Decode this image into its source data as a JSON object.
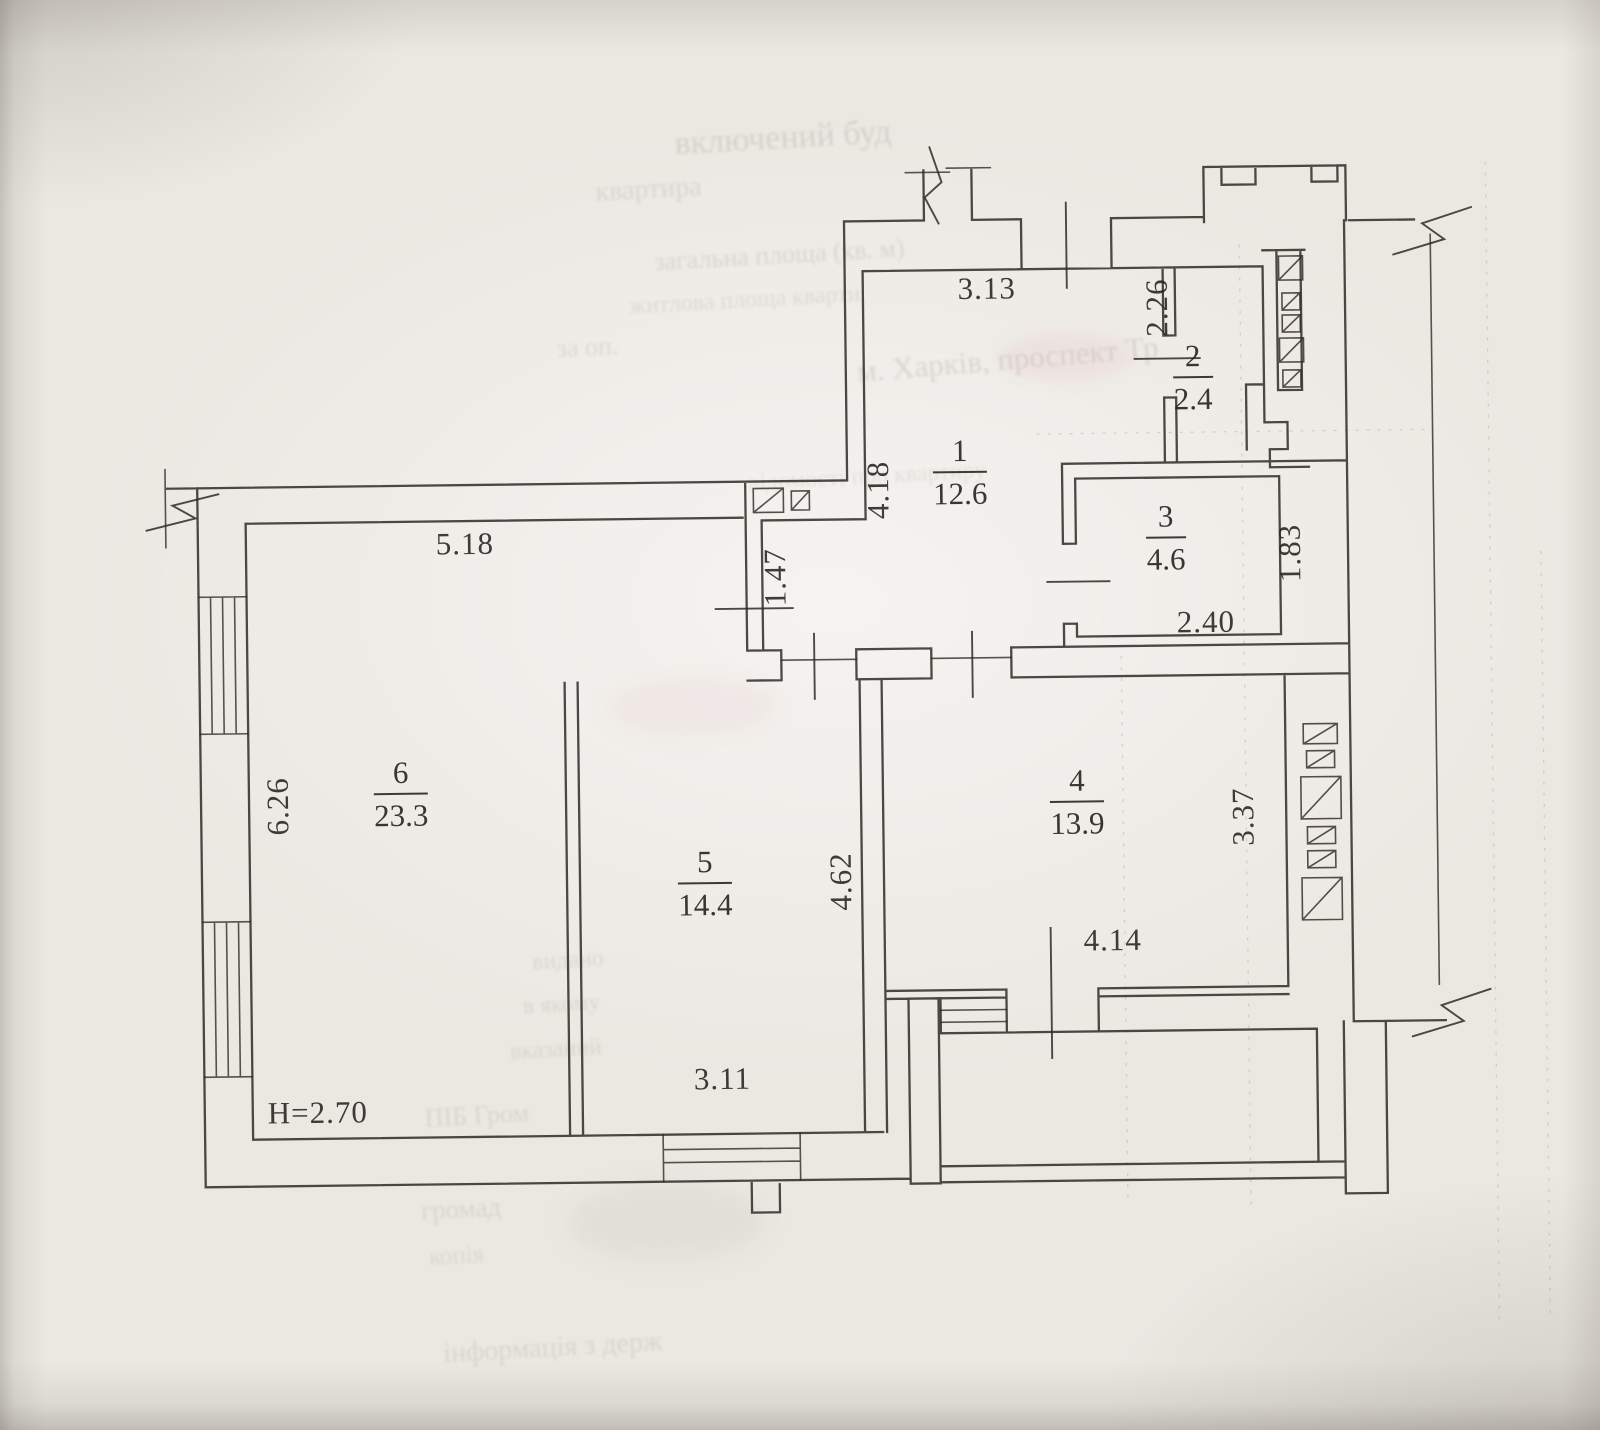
{
  "document": {
    "kind": "scanned apartment floor plan",
    "ceiling_height": "H=2.70"
  },
  "plan": {
    "rooms": [
      {
        "number": "1",
        "area": "12.6"
      },
      {
        "number": "2",
        "area": "2.4"
      },
      {
        "number": "3",
        "area": "4.6"
      },
      {
        "number": "4",
        "area": "13.9"
      },
      {
        "number": "5",
        "area": "14.4"
      },
      {
        "number": "6",
        "area": "23.3"
      }
    ],
    "dims": {
      "entry_top": "3.13",
      "room2_left": "2.26",
      "hall_left": "4.18",
      "alcove": "1.47",
      "room6_top": "5.18",
      "room6_left": "6.26",
      "room3_bottom": "2.40",
      "room3_right": "1.83",
      "room5_right": "4.62",
      "room4_right": "3.37",
      "room4_bottom": "4.14",
      "room5_bottom": "3.11",
      "height": "H=2.70"
    }
  },
  "ghost_text": {
    "g1": "включений буд",
    "g2": "квартира",
    "g3": "загальна площа (кв. м)",
    "g4": "житлова площа кварти",
    "g5": "за оп.",
    "g6": "м. Харків, проспект Тр",
    "g7": "відомості про квартиру",
    "g8": "видано",
    "g9": "в якому",
    "g10": "вказаний",
    "g11": "ПІБ Гром",
    "g12": "громад",
    "g13": "копія",
    "g14": "інформація з держ"
  },
  "colors": {
    "ink": "#2e2a26",
    "paper": "#ebe8e2",
    "smudge_pink": "#d9a0a8"
  }
}
